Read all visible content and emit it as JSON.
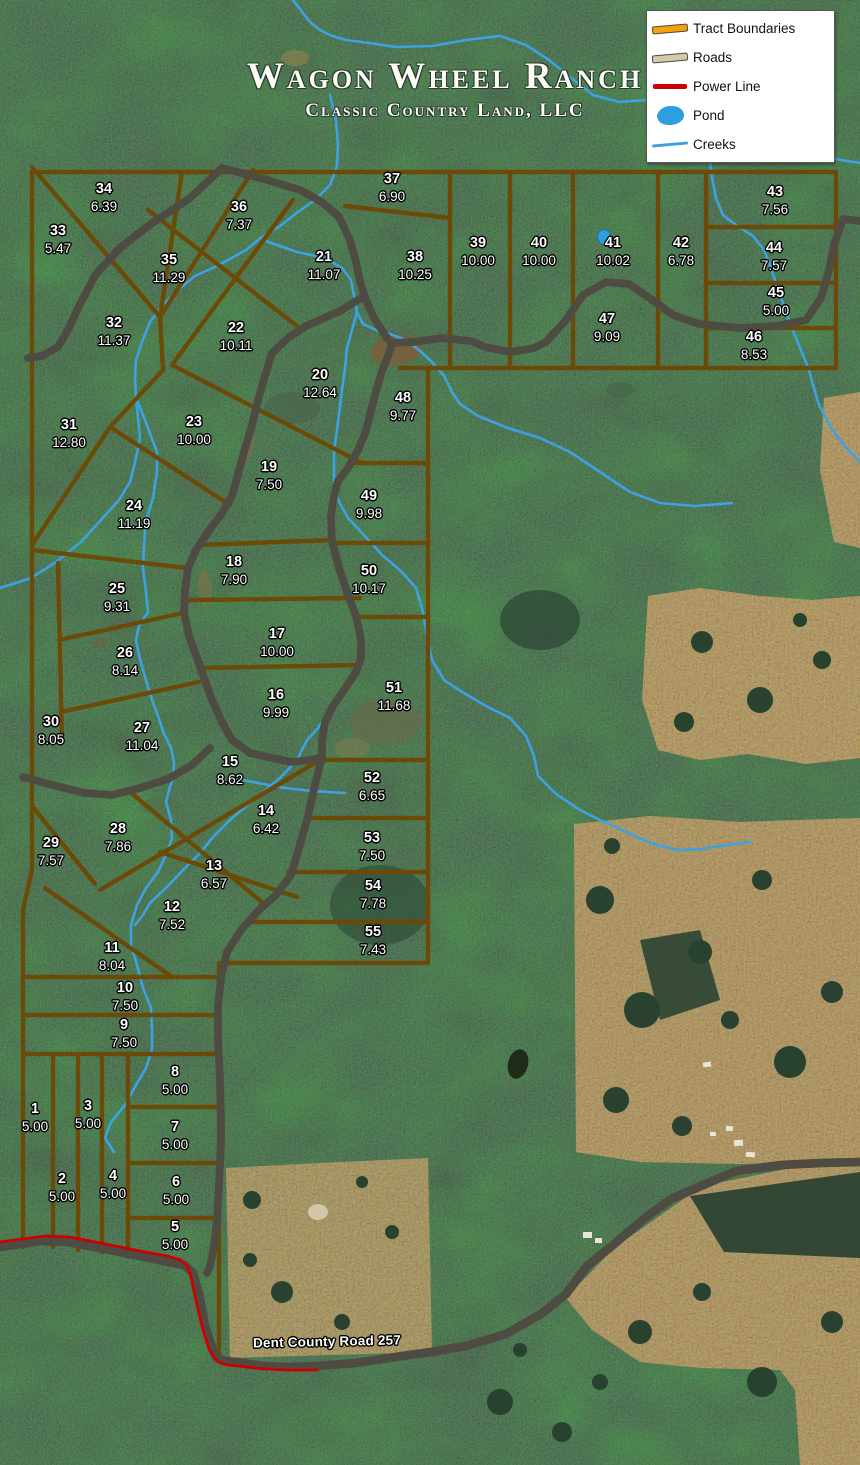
{
  "title": {
    "main": "Wagon Wheel Ranch",
    "subtitle": "Classic Country Land, LLC"
  },
  "legend": {
    "items": [
      {
        "label": "Tract Boundaries",
        "icon": "tract-boundary-line"
      },
      {
        "label": "Roads",
        "icon": "road-line"
      },
      {
        "label": "Power Line",
        "icon": "power-line"
      },
      {
        "label": "Pond",
        "icon": "pond-blob"
      },
      {
        "label": "Creeks",
        "icon": "creek-line"
      }
    ]
  },
  "map": {
    "road_label": "Dent County Road 257",
    "colors": {
      "tract_boundary": "#F2A30B",
      "road_fill": "#D5C8AC",
      "road_casing": "#4E4C42",
      "power_line": "#CC0000",
      "pond": "#2D9FDE",
      "creek": "#3DA2E2",
      "forest": "#2C4636",
      "field": "#B59C6F"
    },
    "tracts": [
      {
        "id": "1",
        "acres": "5.00",
        "x": 35,
        "y": 1110
      },
      {
        "id": "2",
        "acres": "5.00",
        "x": 62,
        "y": 1180
      },
      {
        "id": "3",
        "acres": "5.00",
        "x": 88,
        "y": 1107
      },
      {
        "id": "4",
        "acres": "5.00",
        "x": 113,
        "y": 1177
      },
      {
        "id": "5",
        "acres": "5.00",
        "x": 175,
        "y": 1228
      },
      {
        "id": "6",
        "acres": "5.00",
        "x": 176,
        "y": 1183
      },
      {
        "id": "7",
        "acres": "5.00",
        "x": 175,
        "y": 1128
      },
      {
        "id": "8",
        "acres": "5.00",
        "x": 175,
        "y": 1073
      },
      {
        "id": "9",
        "acres": "7.50",
        "x": 124,
        "y": 1026
      },
      {
        "id": "10",
        "acres": "7.50",
        "x": 125,
        "y": 989
      },
      {
        "id": "11",
        "acres": "8.04",
        "x": 112,
        "y": 949
      },
      {
        "id": "12",
        "acres": "7.52",
        "x": 172,
        "y": 908
      },
      {
        "id": "13",
        "acres": "6.57",
        "x": 214,
        "y": 867
      },
      {
        "id": "14",
        "acres": "6.42",
        "x": 266,
        "y": 812
      },
      {
        "id": "15",
        "acres": "8.62",
        "x": 230,
        "y": 763
      },
      {
        "id": "16",
        "acres": "9.99",
        "x": 276,
        "y": 696
      },
      {
        "id": "17",
        "acres": "10.00",
        "x": 277,
        "y": 635
      },
      {
        "id": "18",
        "acres": "7.90",
        "x": 234,
        "y": 563
      },
      {
        "id": "19",
        "acres": "7.50",
        "x": 269,
        "y": 468
      },
      {
        "id": "20",
        "acres": "12.64",
        "x": 320,
        "y": 376
      },
      {
        "id": "21",
        "acres": "11.07",
        "x": 324,
        "y": 258
      },
      {
        "id": "22",
        "acres": "10.11",
        "x": 236,
        "y": 329
      },
      {
        "id": "23",
        "acres": "10.00",
        "x": 194,
        "y": 423
      },
      {
        "id": "24",
        "acres": "11.19",
        "x": 134,
        "y": 507
      },
      {
        "id": "25",
        "acres": "9.31",
        "x": 117,
        "y": 590
      },
      {
        "id": "26",
        "acres": "8.14",
        "x": 125,
        "y": 654
      },
      {
        "id": "27",
        "acres": "11.04",
        "x": 142,
        "y": 729
      },
      {
        "id": "28",
        "acres": "7.86",
        "x": 118,
        "y": 830
      },
      {
        "id": "29",
        "acres": "7.57",
        "x": 51,
        "y": 844
      },
      {
        "id": "30",
        "acres": "8.05",
        "x": 51,
        "y": 723
      },
      {
        "id": "31",
        "acres": "12.80",
        "x": 69,
        "y": 426
      },
      {
        "id": "32",
        "acres": "11.37",
        "x": 114,
        "y": 324
      },
      {
        "id": "33",
        "acres": "5.47",
        "x": 58,
        "y": 232
      },
      {
        "id": "34",
        "acres": "6.39",
        "x": 104,
        "y": 190
      },
      {
        "id": "35",
        "acres": "11.29",
        "x": 169,
        "y": 261
      },
      {
        "id": "36",
        "acres": "7.37",
        "x": 239,
        "y": 208
      },
      {
        "id": "37",
        "acres": "6.90",
        "x": 392,
        "y": 180
      },
      {
        "id": "38",
        "acres": "10.25",
        "x": 415,
        "y": 258
      },
      {
        "id": "39",
        "acres": "10.00",
        "x": 478,
        "y": 244
      },
      {
        "id": "40",
        "acres": "10.00",
        "x": 539,
        "y": 244
      },
      {
        "id": "41",
        "acres": "10.02",
        "x": 613,
        "y": 244
      },
      {
        "id": "42",
        "acres": "6.78",
        "x": 681,
        "y": 244
      },
      {
        "id": "43",
        "acres": "7.56",
        "x": 775,
        "y": 193
      },
      {
        "id": "44",
        "acres": "7.57",
        "x": 774,
        "y": 249
      },
      {
        "id": "45",
        "acres": "5.00",
        "x": 776,
        "y": 294
      },
      {
        "id": "46",
        "acres": "8.53",
        "x": 754,
        "y": 338
      },
      {
        "id": "47",
        "acres": "9.09",
        "x": 607,
        "y": 320
      },
      {
        "id": "48",
        "acres": "9.77",
        "x": 403,
        "y": 399
      },
      {
        "id": "49",
        "acres": "9.98",
        "x": 369,
        "y": 497
      },
      {
        "id": "50",
        "acres": "10.17",
        "x": 369,
        "y": 572
      },
      {
        "id": "51",
        "acres": "11.68",
        "x": 394,
        "y": 689
      },
      {
        "id": "52",
        "acres": "6.65",
        "x": 372,
        "y": 779
      },
      {
        "id": "53",
        "acres": "7.50",
        "x": 372,
        "y": 839
      },
      {
        "id": "54",
        "acres": "7.78",
        "x": 373,
        "y": 887
      },
      {
        "id": "55",
        "acres": "7.43",
        "x": 373,
        "y": 933
      }
    ]
  }
}
